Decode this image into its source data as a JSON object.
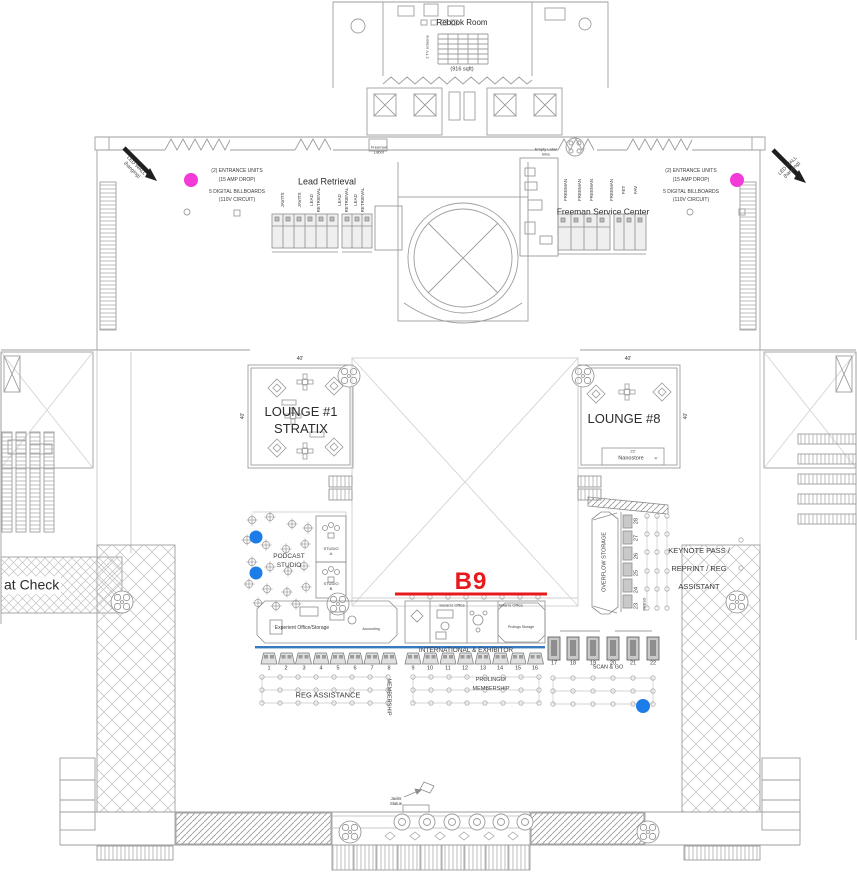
{
  "annotations": {
    "rebook_room": "Rebook Room",
    "rebook_sqft": "(916 sqft)",
    "tv_screens": "2 TV screens",
    "freeman_labor_l1": "Freeman",
    "freeman_labor_l2": "Labor",
    "empty_label_l1": "Empty Label",
    "empty_label_l2": "Bins",
    "lead_retrieval": "Lead Retrieval",
    "freeman_service_center": "Freeman Service Center",
    "led_wall_l1": "LED WALL",
    "led_wall_l2": "(hanging)",
    "entrance_l1": "(2) ENTRANCE UNITS",
    "entrance_l2": "(15 AMP DROP)",
    "billboards_l1": "5 DIGITAL BILLBOARDS",
    "billboards_l2": "(110V CIRCUIT)",
    "coat_check": "at Check",
    "javits_l1": "Javits",
    "javits_l2": "Statue"
  },
  "booths": {
    "lead_cols": [
      "JAVITS",
      "JAVITS",
      "LEAD",
      "RETRIEVAL",
      "LEAD",
      "RETRIEVAL",
      "LEAD",
      "RETRIEVAL"
    ],
    "freeman_cols": [
      "FREEMAN",
      "FREEMAN",
      "FREEMAN",
      "FREEMAN",
      "FET",
      "FAV"
    ]
  },
  "lounge1": {
    "l1": "LOUNGE #1",
    "l2": "STRATIX",
    "dim_top": "40'",
    "dim_left": "40'"
  },
  "lounge8": {
    "label": "LOUNGE #8",
    "dim_top": "40'",
    "dim_right": "40'",
    "nanostore": "Nanostore",
    "nano_w": "22'",
    "nano_d": "4'"
  },
  "marker_b9": {
    "label": "B9"
  },
  "podcast": {
    "l1": "PODCAST",
    "l2": "STUDIO",
    "a1": "STUDIO",
    "a2": "A",
    "b1": "STUDIO",
    "b2": "B"
  },
  "storage": {
    "overflow": "OVERFLOW STORAGE",
    "press": "PRESS",
    "numbers": [
      "28",
      "27",
      "26",
      "25",
      "24",
      "23"
    ]
  },
  "keynote": {
    "l1": "KEYNOTE PASS /",
    "l2": "REPRINT / REG",
    "l3": "ASSISTANT"
  },
  "offices": {
    "experient": "Experient Office/Storage",
    "accounting": "Accounting",
    "susan": "Susan's Office",
    "brian": "Brian's Office",
    "prolingo": "Prolingo Storage"
  },
  "counters": {
    "row1": [
      "1",
      "2",
      "3",
      "4",
      "5",
      "6",
      "7",
      "8"
    ],
    "row2": [
      "9",
      "10",
      "11",
      "12",
      "13",
      "14",
      "15",
      "16"
    ],
    "scan": [
      "17",
      "18",
      "19",
      "20",
      "21",
      "22"
    ]
  },
  "areas": {
    "reg_assistance": "REG ASSISTANCE",
    "membership": "MEMBERSHIP",
    "international": "INTERNATIONAL & EXHIBITOR",
    "prolingo_l1": "PROLINGO/",
    "prolingo_l2": "MEMBERSHIP",
    "scan_go": "SCAN & GO"
  },
  "colors": {
    "accent_red": "#e8191d",
    "magenta": "#f23bd9",
    "blue": "#1d7de8",
    "counter_blue": "#3579c0"
  }
}
